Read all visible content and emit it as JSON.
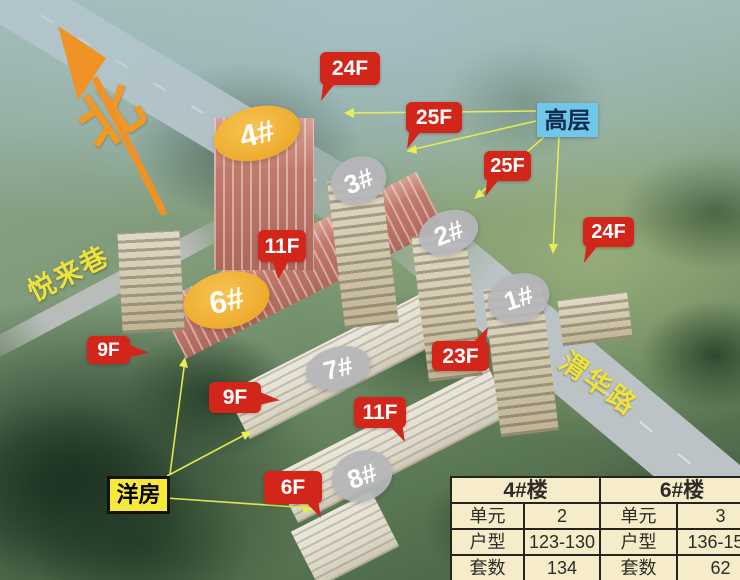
{
  "compass": {
    "label": "北"
  },
  "streets": {
    "yuelai": {
      "text": "悦来巷"
    },
    "weihua": {
      "text": "渭华路"
    }
  },
  "tags": {
    "highrise": {
      "text": "高层"
    },
    "garden": {
      "text": "洋房"
    }
  },
  "buildings": {
    "b4": {
      "label": "4#"
    },
    "b6": {
      "label": "6#"
    },
    "b3": {
      "label": "3#"
    },
    "b2": {
      "label": "2#"
    },
    "b1": {
      "label": "1#"
    },
    "b7": {
      "label": "7#"
    },
    "b8": {
      "label": "8#"
    }
  },
  "floor_badges": [
    {
      "text": "24F"
    },
    {
      "text": "25F"
    },
    {
      "text": "25F"
    },
    {
      "text": "24F"
    },
    {
      "text": "11F"
    },
    {
      "text": "9F"
    },
    {
      "text": "9F"
    },
    {
      "text": "23F"
    },
    {
      "text": "11F"
    },
    {
      "text": "6F"
    }
  ],
  "table": {
    "sections": [
      {
        "header": "4#楼",
        "rows": [
          {
            "label": "单元",
            "value": "2"
          },
          {
            "label": "户型",
            "value": "123-130"
          },
          {
            "label": "套数",
            "value": "134"
          }
        ]
      },
      {
        "header": "6#楼",
        "rows": [
          {
            "label": "单元",
            "value": "3"
          },
          {
            "label": "户型",
            "value": "136-155"
          },
          {
            "label": "套数",
            "value": "62"
          }
        ]
      }
    ]
  },
  "colors": {
    "badge_red": "#d2261b",
    "ellipse_orange": "#edaa2c",
    "ellipse_gray": "#b6b6ba",
    "tag_blue": "#6fc8e8",
    "tag_yellow": "#f6e93a",
    "street_yellow": "#eee23e",
    "connector_yellow": "#e8ef54",
    "compass_orange": "#f09a26",
    "table_bg": "#f6ecca"
  }
}
